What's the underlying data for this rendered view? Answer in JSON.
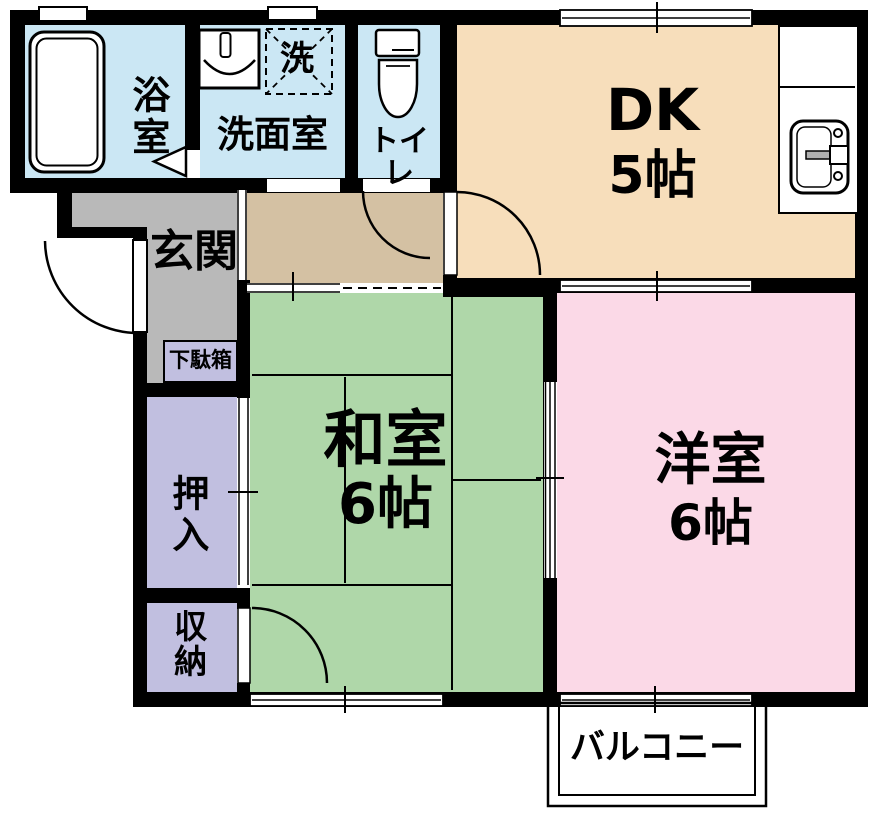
{
  "plan": {
    "wall_color": "#000000",
    "rooms": {
      "bath": {
        "label": "浴室",
        "color": "#cbe7f4"
      },
      "washroom": {
        "label": "洗面室",
        "color": "#cbe7f4"
      },
      "washer": {
        "label": "洗"
      },
      "toilet": {
        "label": "トイレ",
        "color": "#cbe7f4"
      },
      "dk": {
        "label": "DK",
        "size": "5帖",
        "color": "#f7debb"
      },
      "hall": {
        "color": "#d4c1a3"
      },
      "genkan": {
        "label": "玄関",
        "color": "#b9b9b9"
      },
      "getabako": {
        "label": "下駄箱",
        "color": "#c1bfe0"
      },
      "oshiire": {
        "label": "押入",
        "color": "#c1bfe0"
      },
      "shuno": {
        "label": "収納",
        "color": "#c1bfe0"
      },
      "washitsu": {
        "label": "和室",
        "size": "6帖",
        "color": "#afd7a9"
      },
      "youshitsu": {
        "label": "洋室",
        "size": "6帖",
        "color": "#fbd9e7"
      },
      "balcony": {
        "label": "バルコニー"
      }
    }
  }
}
